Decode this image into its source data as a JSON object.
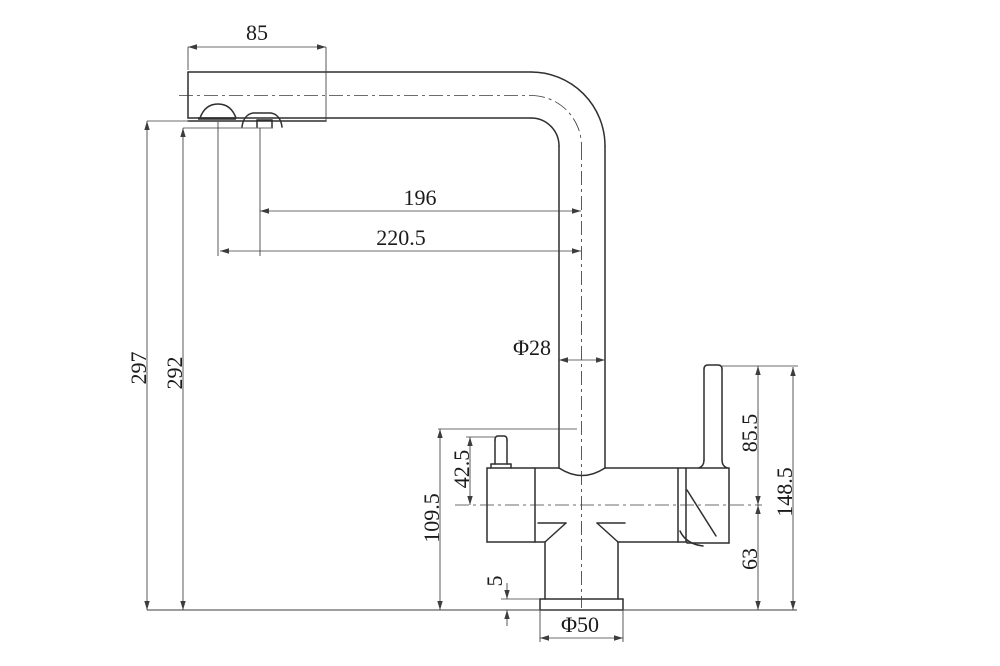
{
  "drawing_type": "faucet-technical-dimension-drawing",
  "canvas": {
    "width": 1000,
    "height": 666,
    "background": "#ffffff"
  },
  "colors": {
    "outline": "#2f2f2f",
    "thin": "#3d3d3d",
    "text": "#1b1b1b"
  },
  "dimensions_mm": {
    "spout_tip_length": "85",
    "tip_to_riser_center_a": "196",
    "tip_to_riser_center_b": "220.5",
    "height_outlet": "297",
    "height_diverter": "292",
    "riser_diameter": "Φ28",
    "body_height": "109.5",
    "nub_to_center": "42.5",
    "base_plate_thickness": "5",
    "base_diameter": "Φ50",
    "lever_top_to_center": "85.5",
    "center_to_counter": "63",
    "lever_top_to_counter": "148.5"
  },
  "drawing": {
    "outline_segments": [
      [
        188,
        72,
        531,
        72
      ],
      [
        188,
        118,
        531,
        118
      ],
      [
        188,
        72,
        188,
        118
      ],
      [
        188,
        121,
        326,
        121
      ],
      [
        605,
        146,
        605,
        468
      ],
      [
        559,
        146,
        559,
        468
      ],
      [
        487,
        468,
        559,
        468
      ],
      [
        605,
        468,
        729,
        468
      ],
      [
        487,
        542,
        545,
        542
      ],
      [
        618,
        542,
        687,
        542
      ],
      [
        687,
        543,
        729,
        543
      ],
      [
        487,
        468,
        487,
        542
      ],
      [
        535,
        468,
        535,
        542
      ],
      [
        678,
        468,
        678,
        542
      ],
      [
        686,
        468,
        686,
        542
      ],
      [
        729,
        468,
        729,
        543
      ],
      [
        538,
        523,
        566,
        523
      ],
      [
        566,
        523,
        545,
        542
      ],
      [
        597,
        523,
        625,
        523
      ],
      [
        597,
        523,
        618,
        542
      ],
      [
        545,
        542,
        545,
        599
      ],
      [
        618,
        542,
        618,
        599
      ],
      [
        540,
        599,
        623,
        599
      ],
      [
        540,
        610,
        623,
        610
      ],
      [
        540,
        599,
        540,
        610
      ],
      [
        623,
        599,
        623,
        610
      ],
      [
        704,
        369,
        704,
        460
      ],
      [
        722,
        369,
        722,
        460
      ],
      [
        687,
        490,
        716,
        536
      ],
      [
        495,
        440,
        495,
        464
      ],
      [
        507,
        440,
        507,
        464
      ],
      [
        491,
        464,
        491,
        468
      ],
      [
        511,
        464,
        511,
        468
      ],
      [
        491,
        464,
        511,
        464
      ],
      [
        257,
        127,
        257,
        120
      ],
      [
        272,
        127,
        272,
        120
      ],
      [
        257,
        120,
        272,
        120
      ]
    ],
    "bold_segments": [
      [
        198,
        118.5,
        236,
        118.5
      ]
    ],
    "outline_paths": [
      "M531,72 A74,74 0 0 1 605,146",
      "M531,118 A28,28 0 0 1 559,146",
      "M559,468 Q582,483 605,468",
      "M200,118 C204,107 211,104 218,104 C225,104 232,107 236,118",
      "M242,127 C243,119 247,114 253,113 L271,113 C277,114 281,119 282,127",
      "M704,369 Q704,365 708,365 L718,365 Q722,365 722,369",
      "M704,460 Q704,466 699,468",
      "M722,460 Q722,466 727,468",
      "M495,440 Q495,436 498,436 L504,436 Q507,436 507,440",
      "M680,531 Q686,544 703,546"
    ],
    "baseline": [
      147,
      610,
      797,
      610
    ],
    "centerline_paths": [
      "M179,95.5 H531",
      "M531,95.5 A50.5,50.5 0 0 1 581.5,146",
      "M581.5,146 V608",
      "M455,505 H762"
    ],
    "extension_segments": [
      [
        147,
        121,
        190,
        121
      ],
      [
        183,
        128,
        273,
        128
      ],
      [
        218,
        122,
        218,
        256
      ],
      [
        260,
        128,
        260,
        256
      ],
      [
        188,
        47,
        188,
        70
      ],
      [
        326,
        47,
        326,
        121
      ],
      [
        438,
        429,
        577,
        429
      ],
      [
        466,
        437,
        496,
        437
      ],
      [
        722,
        366,
        798,
        366
      ],
      [
        501,
        599,
        540,
        599
      ],
      [
        540,
        611,
        540,
        642
      ],
      [
        623,
        611,
        623,
        642
      ]
    ],
    "hdims": [
      {
        "t": "85",
        "x1": 188,
        "x2": 326,
        "y": 47,
        "lx": 257,
        "ly": 40
      },
      {
        "t": "196",
        "x1": 260,
        "x2": 581,
        "y": 211,
        "lx": 420,
        "ly": 205
      },
      {
        "t": "220.5",
        "x1": 220,
        "x2": 581,
        "y": 251,
        "lx": 401,
        "ly": 245
      },
      {
        "t": "Φ28",
        "x1": 559,
        "x2": 605,
        "y": 360,
        "lx": 532,
        "ly": 355
      },
      {
        "t": "Φ50",
        "x1": 540,
        "x2": 623,
        "y": 638,
        "lx": 580,
        "ly": 632
      }
    ],
    "vdims": [
      {
        "t": "297",
        "x": 147,
        "y1": 121,
        "y2": 610,
        "lx": 146,
        "ly": 368
      },
      {
        "t": "292",
        "x": 183,
        "y1": 128,
        "y2": 610,
        "lx": 182,
        "ly": 373
      },
      {
        "t": "109.5",
        "x": 440,
        "y1": 429,
        "y2": 610,
        "lx": 439,
        "ly": 518
      },
      {
        "t": "42.5",
        "x": 470,
        "y1": 437,
        "y2": 505,
        "lx": 469,
        "ly": 469
      },
      {
        "t": "85.5",
        "x": 758,
        "y1": 366,
        "y2": 505,
        "lx": 757,
        "ly": 433
      },
      {
        "t": "63",
        "x": 758,
        "y1": 505,
        "y2": 610,
        "lx": 757,
        "ly": 559
      },
      {
        "t": "148.5",
        "x": 793,
        "y1": 367,
        "y2": 610,
        "lx": 792,
        "ly": 492
      }
    ],
    "outside_dim": {
      "t": "5",
      "x": 507,
      "yTop": 599,
      "yBot": 610,
      "stem": 16,
      "lx": 502,
      "ly": 581
    },
    "arrow": {
      "len": 9,
      "halfw": 2.7
    },
    "font_size": 22
  }
}
